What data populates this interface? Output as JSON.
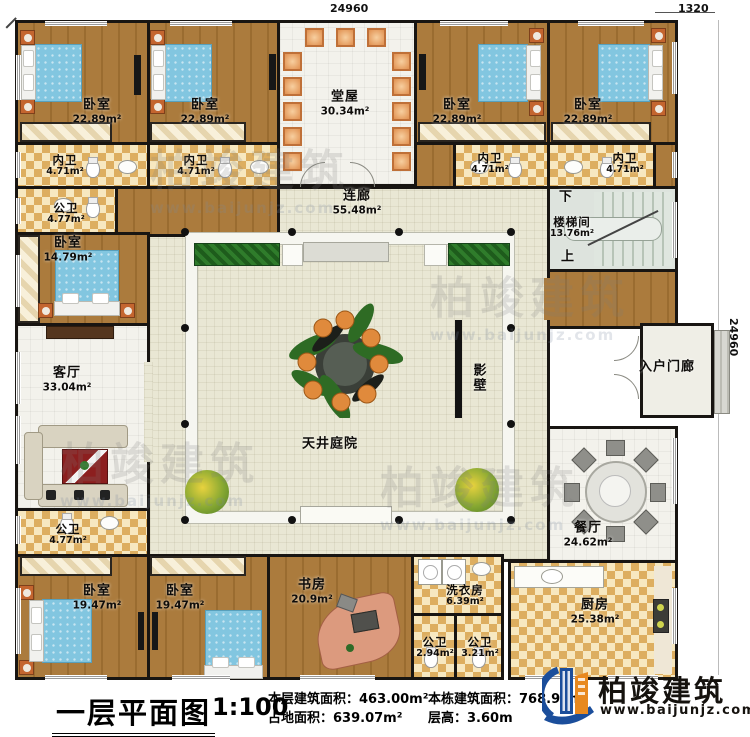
{
  "dimensions": {
    "top": "24960",
    "top_right": "1320",
    "right": "24960"
  },
  "rooms": {
    "bedroom_tl1": {
      "name": "卧室",
      "area": "22.89m²"
    },
    "bedroom_tl2": {
      "name": "卧室",
      "area": "22.89m²"
    },
    "bedroom_tr1": {
      "name": "卧室",
      "area": "22.89m²"
    },
    "bedroom_tr2": {
      "name": "卧室",
      "area": "22.89m²"
    },
    "neiwei1": {
      "name": "内卫",
      "area": "4.71m²"
    },
    "neiwei2": {
      "name": "内卫",
      "area": "4.71m²"
    },
    "neiwei3": {
      "name": "内卫",
      "area": "4.71m²"
    },
    "neiwei4": {
      "name": "内卫",
      "area": "4.71m²"
    },
    "gongwei1": {
      "name": "公卫",
      "area": "4.77m²"
    },
    "gongwei2": {
      "name": "公卫",
      "area": "4.77m²"
    },
    "tangwu": {
      "name": "堂屋",
      "area": "30.34m²"
    },
    "lianlang": {
      "name": "连廊",
      "area": "55.48m²"
    },
    "staircase": {
      "name": "楼梯间",
      "area": "13.76m²",
      "down": "下",
      "up": "上"
    },
    "bedroom_left": {
      "name": "卧室",
      "area": "14.79m²"
    },
    "living": {
      "name": "客厅",
      "area": "33.04m²"
    },
    "yingbi": {
      "name": "影壁"
    },
    "courtyard": {
      "name": "天井庭院"
    },
    "porch": {
      "name": "入户门廊"
    },
    "dining": {
      "name": "餐厅",
      "area": "24.62m²"
    },
    "kitchen": {
      "name": "厨房",
      "area": "25.38m²"
    },
    "bedroom_bl1": {
      "name": "卧室",
      "area": "19.47m²"
    },
    "bedroom_bl2": {
      "name": "卧室",
      "area": "19.47m²"
    },
    "study": {
      "name": "书房",
      "area": "20.9m²"
    },
    "laundry": {
      "name": "洗衣房",
      "area": "6.39m²"
    },
    "gongwei3": {
      "name": "公卫",
      "area": "2.94m²"
    },
    "gongwei4": {
      "name": "公卫",
      "area": "3.21m²"
    }
  },
  "footer": {
    "title": "一层平面图",
    "scale": "1:100",
    "stats": [
      {
        "label": "本层建筑面积：",
        "value": "463.00m²"
      },
      {
        "label": "占地面积：",
        "value": "639.07m²"
      },
      {
        "label": "本栋建筑面积：",
        "value": "768.93m²"
      },
      {
        "label": "层高：",
        "value": "3.60m"
      }
    ],
    "logo": {
      "name": "柏竣建筑",
      "url": "www.baijunjz.com"
    }
  },
  "watermark": {
    "name": "柏竣建筑",
    "url": "www.baijunjz.com"
  },
  "colors": {
    "wall": "#181512",
    "wood": "#ab7b3d",
    "checker_light": "#f7e8c0",
    "checker_dark": "#ddae60",
    "bed": "#82c6e0",
    "logo_blue": "#1b4e9b",
    "logo_orange": "#e8891f"
  }
}
